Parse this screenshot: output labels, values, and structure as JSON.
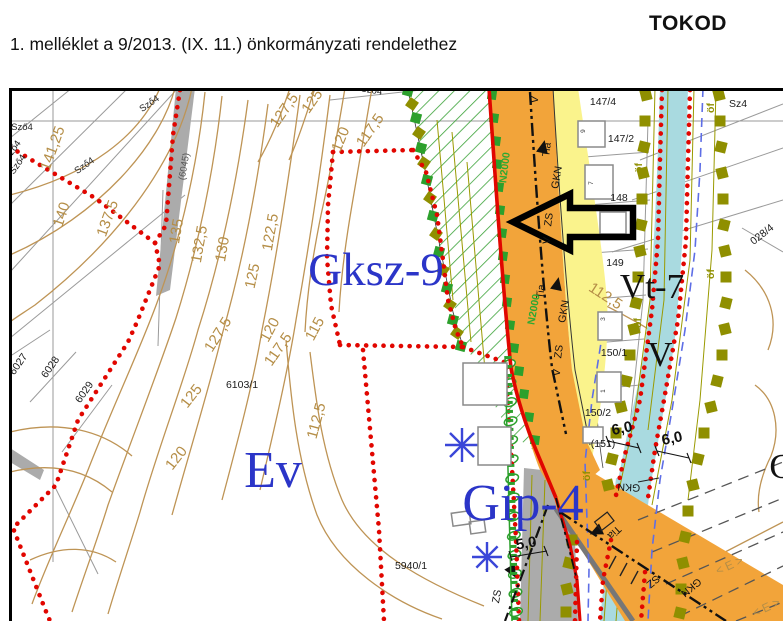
{
  "header": {
    "annex_line": "1. melléklet a 9/2013. (IX. 11.) önkormányzati rendelethez",
    "municipality": "TOKOD"
  },
  "map": {
    "colors": {
      "road_orange": "#F2A43A",
      "stream_cyan": "#A9DAE0",
      "hatch_green": "#3BA339",
      "boundary_red": "#E10600",
      "olive_marker": "#8F8F00",
      "zone_label_blue": "#2B35C8",
      "contour_tan": "#B58E47",
      "gray_fill": "#ABABAB",
      "blue_dash": "#5E6EE6",
      "yellow_strip": "#FAF38C"
    },
    "labels": [
      {
        "t": "141,25",
        "x": 57,
        "y": 150,
        "r": -70,
        "c": "contour"
      },
      {
        "t": "140",
        "x": 66,
        "y": 216,
        "r": -72,
        "c": "contour"
      },
      {
        "t": "137,5",
        "x": 112,
        "y": 220,
        "r": -70,
        "c": "contour"
      },
      {
        "t": "135",
        "x": 181,
        "y": 232,
        "r": -80,
        "c": "contour"
      },
      {
        "t": "132,5",
        "x": 204,
        "y": 245,
        "r": -80,
        "c": "contour"
      },
      {
        "t": "130",
        "x": 227,
        "y": 250,
        "r": -80,
        "c": "contour"
      },
      {
        "t": "122,5",
        "x": 275,
        "y": 233,
        "r": -80,
        "c": "contour"
      },
      {
        "t": "125",
        "x": 257,
        "y": 277,
        "r": -78,
        "c": "contour"
      },
      {
        "t": "127,5",
        "x": 222,
        "y": 337,
        "r": -58,
        "c": "contour"
      },
      {
        "t": "120",
        "x": 274,
        "y": 332,
        "r": -62,
        "c": "contour"
      },
      {
        "t": "117,5",
        "x": 282,
        "y": 352,
        "r": -55,
        "c": "contour"
      },
      {
        "t": "127,5",
        "x": 288,
        "y": 113,
        "r": -55,
        "c": "contour"
      },
      {
        "t": "125",
        "x": 316,
        "y": 104,
        "r": -55,
        "c": "contour"
      },
      {
        "t": "120",
        "x": 345,
        "y": 141,
        "r": -68,
        "c": "contour"
      },
      {
        "t": "117,5",
        "x": 374,
        "y": 133,
        "r": -55,
        "c": "contour"
      },
      {
        "t": "115",
        "x": 319,
        "y": 331,
        "r": -62,
        "c": "contour"
      },
      {
        "t": "112,5",
        "x": 321,
        "y": 422,
        "r": -75,
        "c": "contour"
      },
      {
        "t": "112,5",
        "x": 603,
        "y": 300,
        "r": 33,
        "c": "contour"
      },
      {
        "t": "125",
        "x": 195,
        "y": 399,
        "r": -52,
        "c": "contour"
      },
      {
        "t": "120",
        "x": 180,
        "y": 461,
        "r": -52,
        "c": "contour"
      },
      {
        "t": "147/4",
        "x": 603,
        "y": 105,
        "r": 0,
        "c": "parcel"
      },
      {
        "t": "147/2",
        "x": 621,
        "y": 142,
        "r": 0,
        "c": "parcel"
      },
      {
        "t": "148",
        "x": 619,
        "y": 201,
        "r": 0,
        "c": "parcel"
      },
      {
        "t": "149",
        "x": 615,
        "y": 266,
        "r": 0,
        "c": "parcel"
      },
      {
        "t": "150/1",
        "x": 614,
        "y": 356,
        "r": 0,
        "c": "parcel"
      },
      {
        "t": "150/2",
        "x": 598,
        "y": 416,
        "r": 0,
        "c": "parcel"
      },
      {
        "t": "(151)",
        "x": 603,
        "y": 447,
        "r": 0,
        "c": "parcel"
      },
      {
        "t": "6103/1",
        "x": 242,
        "y": 388,
        "r": 0,
        "c": "parcel"
      },
      {
        "t": "5940/1",
        "x": 411,
        "y": 569,
        "r": 0,
        "c": "parcel"
      },
      {
        "t": "028/4",
        "x": 764,
        "y": 237,
        "r": -38,
        "c": "parcel"
      },
      {
        "t": "Sz4",
        "x": 738,
        "y": 107,
        "r": 0,
        "c": "parcel"
      },
      {
        "t": "6027",
        "x": 21,
        "y": 366,
        "r": -55,
        "c": "parcel"
      },
      {
        "t": "6028",
        "x": 53,
        "y": 369,
        "r": -55,
        "c": "parcel"
      },
      {
        "t": "6029",
        "x": 87,
        "y": 394,
        "r": -55,
        "c": "parcel"
      },
      {
        "t": "(6045)",
        "x": 187,
        "y": 167,
        "r": -80,
        "c": "parcel-gray"
      },
      {
        "t": "Sző4",
        "x": 22,
        "y": 130,
        "r": 0,
        "c": "szolo"
      },
      {
        "t": "Sző4",
        "x": 15,
        "y": 152,
        "r": -55,
        "c": "szolo"
      },
      {
        "t": "Sző4",
        "x": 20,
        "y": 166,
        "r": -55,
        "c": "szolo"
      },
      {
        "t": "Sző4",
        "x": 86,
        "y": 168,
        "r": -35,
        "c": "szolo"
      },
      {
        "t": "Sző4",
        "x": 151,
        "y": 106,
        "r": -35,
        "c": "szolo"
      },
      {
        "t": "Sző4",
        "x": 371,
        "y": 93,
        "r": 10,
        "c": "szolo"
      },
      {
        "t": "Gksz-9",
        "x": 376,
        "y": 285,
        "r": 0,
        "c": "zone-blue-lg",
        "n": "zone-label-gksz9"
      },
      {
        "t": "Ev",
        "x": 273,
        "y": 487,
        "r": 0,
        "c": "zone-blue-xl",
        "n": "zone-label-ev"
      },
      {
        "t": "Gip-4",
        "x": 523,
        "y": 520,
        "r": 0,
        "c": "zone-blue-xl",
        "n": "zone-label-gip4"
      },
      {
        "t": "Vt-7",
        "x": 652,
        "y": 298,
        "r": 0,
        "c": "zone-black",
        "n": "zone-label-vt7"
      },
      {
        "t": "V",
        "x": 660,
        "y": 366,
        "r": 0,
        "c": "zone-black",
        "n": "zone-label-v"
      },
      {
        "t": "G",
        "x": 782,
        "y": 478,
        "r": 0,
        "c": "zone-black",
        "n": "zone-label-partial"
      },
      {
        "t": "V",
        "x": 538,
        "y": 100,
        "r": -83,
        "c": "road"
      },
      {
        "t": "Tia",
        "x": 550,
        "y": 150,
        "r": -83,
        "c": "road"
      },
      {
        "t": "GKN",
        "x": 560,
        "y": 178,
        "r": -80,
        "c": "road"
      },
      {
        "t": "ZS",
        "x": 552,
        "y": 220,
        "r": -83,
        "c": "road"
      },
      {
        "t": "V",
        "x": 550,
        "y": 241,
        "r": -83,
        "c": "road"
      },
      {
        "t": "Tia",
        "x": 544,
        "y": 292,
        "r": -83,
        "c": "road"
      },
      {
        "t": "GKN",
        "x": 567,
        "y": 312,
        "r": -80,
        "c": "road"
      },
      {
        "t": "ZS",
        "x": 562,
        "y": 352,
        "r": -83,
        "c": "road"
      },
      {
        "t": "V",
        "x": 560,
        "y": 373,
        "r": -83,
        "c": "road"
      },
      {
        "t": "Tia",
        "x": 612,
        "y": 530,
        "r": 137,
        "c": "road"
      },
      {
        "t": "SZ",
        "x": 651,
        "y": 579,
        "r": 140,
        "c": "road"
      },
      {
        "t": "GKN",
        "x": 689,
        "y": 585,
        "r": 140,
        "c": "road"
      },
      {
        "t": "GKN",
        "x": 629,
        "y": 484,
        "r": 183,
        "c": "road"
      },
      {
        "t": "ZS",
        "x": 500,
        "y": 597,
        "r": -80,
        "c": "road"
      },
      {
        "t": "N2000",
        "x": 508,
        "y": 168,
        "r": -83,
        "c": "road-green"
      },
      {
        "t": "N2000",
        "x": 537,
        "y": 310,
        "r": -80,
        "c": "road-green"
      },
      {
        "t": "öf",
        "x": 714,
        "y": 108,
        "r": -90,
        "c": "olive"
      },
      {
        "t": "öf",
        "x": 642,
        "y": 168,
        "r": -90,
        "c": "olive"
      },
      {
        "t": "öf",
        "x": 714,
        "y": 274,
        "r": -90,
        "c": "olive"
      },
      {
        "t": "öf",
        "x": 641,
        "y": 323,
        "r": -90,
        "c": "olive"
      },
      {
        "t": "öf",
        "x": 590,
        "y": 476,
        "r": -90,
        "c": "olive"
      },
      {
        "t": "6,0",
        "x": 623,
        "y": 433,
        "r": -12,
        "c": "dim"
      },
      {
        "t": "6,0",
        "x": 673,
        "y": 443,
        "r": -12,
        "c": "dim"
      },
      {
        "t": "5,0",
        "x": 527,
        "y": 548,
        "r": -10,
        "c": "dim"
      },
      {
        "t": "9",
        "x": 585,
        "y": 131,
        "r": -90,
        "c": "tiny"
      },
      {
        "t": "7",
        "x": 593,
        "y": 183,
        "r": -90,
        "c": "tiny"
      },
      {
        "t": "3",
        "x": 605,
        "y": 319,
        "r": -90,
        "c": "tiny"
      },
      {
        "t": "1",
        "x": 605,
        "y": 391,
        "r": -90,
        "c": "tiny"
      },
      {
        "t": "< E >",
        "x": 731,
        "y": 569,
        "r": -25,
        "c": "forest"
      },
      {
        "t": "< E >",
        "x": 768,
        "y": 611,
        "r": -25,
        "c": "forest"
      }
    ],
    "symbols": {
      "green_squares": [
        [
          492,
          95
        ],
        [
          494,
          118
        ],
        [
          496,
          141
        ],
        [
          497,
          164
        ],
        [
          499,
          187
        ],
        [
          500,
          210
        ],
        [
          502,
          233
        ],
        [
          503,
          256
        ],
        [
          505,
          279
        ],
        [
          507,
          302
        ],
        [
          510,
          325
        ],
        [
          514,
          348
        ],
        [
          519,
          371
        ],
        [
          524,
          394
        ],
        [
          529,
          417
        ],
        [
          535,
          440
        ]
      ],
      "olive_chain_left": [
        [
          646,
          95
        ],
        [
          645,
          121
        ],
        [
          644,
          147
        ],
        [
          643,
          173
        ],
        [
          642,
          199
        ],
        [
          641,
          225
        ],
        [
          640,
          251
        ],
        [
          638,
          277
        ],
        [
          636,
          303
        ],
        [
          634,
          329
        ],
        [
          630,
          355
        ],
        [
          626,
          381
        ],
        [
          621,
          407
        ],
        [
          616,
          433
        ],
        [
          612,
          459
        ],
        [
          608,
          485
        ],
        [
          572,
          540
        ],
        [
          569,
          563
        ],
        [
          567,
          589
        ],
        [
          566,
          612
        ]
      ],
      "olive_chain_right": [
        [
          719,
          95
        ],
        [
          720,
          121
        ],
        [
          721,
          147
        ],
        [
          722,
          173
        ],
        [
          723,
          199
        ],
        [
          724,
          225
        ],
        [
          725,
          251
        ],
        [
          726,
          277
        ],
        [
          726,
          303
        ],
        [
          725,
          329
        ],
        [
          722,
          355
        ],
        [
          717,
          381
        ],
        [
          711,
          407
        ],
        [
          704,
          433
        ],
        [
          698,
          459
        ],
        [
          693,
          485
        ],
        [
          688,
          511
        ],
        [
          685,
          537
        ],
        [
          683,
          563
        ],
        [
          681,
          589
        ],
        [
          680,
          613
        ]
      ],
      "mixed_chain": [
        {
          "x": 408,
          "y": 91,
          "c": "g"
        },
        {
          "x": 412,
          "y": 104,
          "c": "o"
        },
        {
          "x": 416,
          "y": 118,
          "c": "g"
        },
        {
          "x": 419,
          "y": 133,
          "c": "o"
        },
        {
          "x": 421,
          "y": 148,
          "c": "g"
        },
        {
          "x": 424,
          "y": 163,
          "c": "o"
        },
        {
          "x": 427,
          "y": 180,
          "c": "g"
        },
        {
          "x": 430,
          "y": 198,
          "c": "o"
        },
        {
          "x": 433,
          "y": 216,
          "c": "g"
        },
        {
          "x": 436,
          "y": 234,
          "c": "o"
        },
        {
          "x": 439,
          "y": 252,
          "c": "g"
        },
        {
          "x": 443,
          "y": 270,
          "c": "o"
        },
        {
          "x": 447,
          "y": 288,
          "c": "g"
        },
        {
          "x": 450,
          "y": 305,
          "c": "o"
        },
        {
          "x": 453,
          "y": 320,
          "c": "g"
        },
        {
          "x": 457,
          "y": 333,
          "c": "o"
        },
        {
          "x": 461,
          "y": 346,
          "c": "g"
        }
      ],
      "fence": {
        "x1": 509,
        "y1": 364,
        "x2": 516,
        "y2": 612,
        "count": 14
      },
      "stars": [
        {
          "x": 462,
          "y": 445,
          "r": 17
        },
        {
          "x": 487,
          "y": 557,
          "r": 15
        }
      ],
      "triangles": [
        {
          "x": 543,
          "y": 148,
          "r": 12
        },
        {
          "x": 557,
          "y": 285,
          "r": 12
        },
        {
          "x": 597,
          "y": 531,
          "r": -115
        },
        {
          "x": 512,
          "y": 571,
          "r": 150
        }
      ]
    }
  }
}
